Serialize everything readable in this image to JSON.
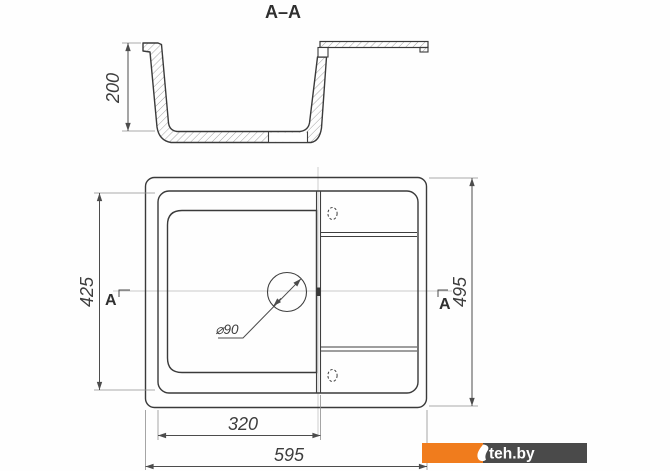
{
  "section": {
    "title": "A–A",
    "depth_dim": "200"
  },
  "plan": {
    "marker_left": "A",
    "marker_right": "A",
    "rim_height_dim": "425",
    "overall_height_dim": "495",
    "bowl_width_dim": "320",
    "overall_width_dim": "595",
    "drain_dim": "⌀90"
  },
  "watermark": {
    "text": "teh.by",
    "orange_color": "#f07c1d",
    "gray_color": "#4a4a4a"
  },
  "colors": {
    "line": "#3a3a3a",
    "dim_line": "#4c4c4c",
    "faint_line": "#c9c9c9",
    "background": "#ffffff"
  }
}
